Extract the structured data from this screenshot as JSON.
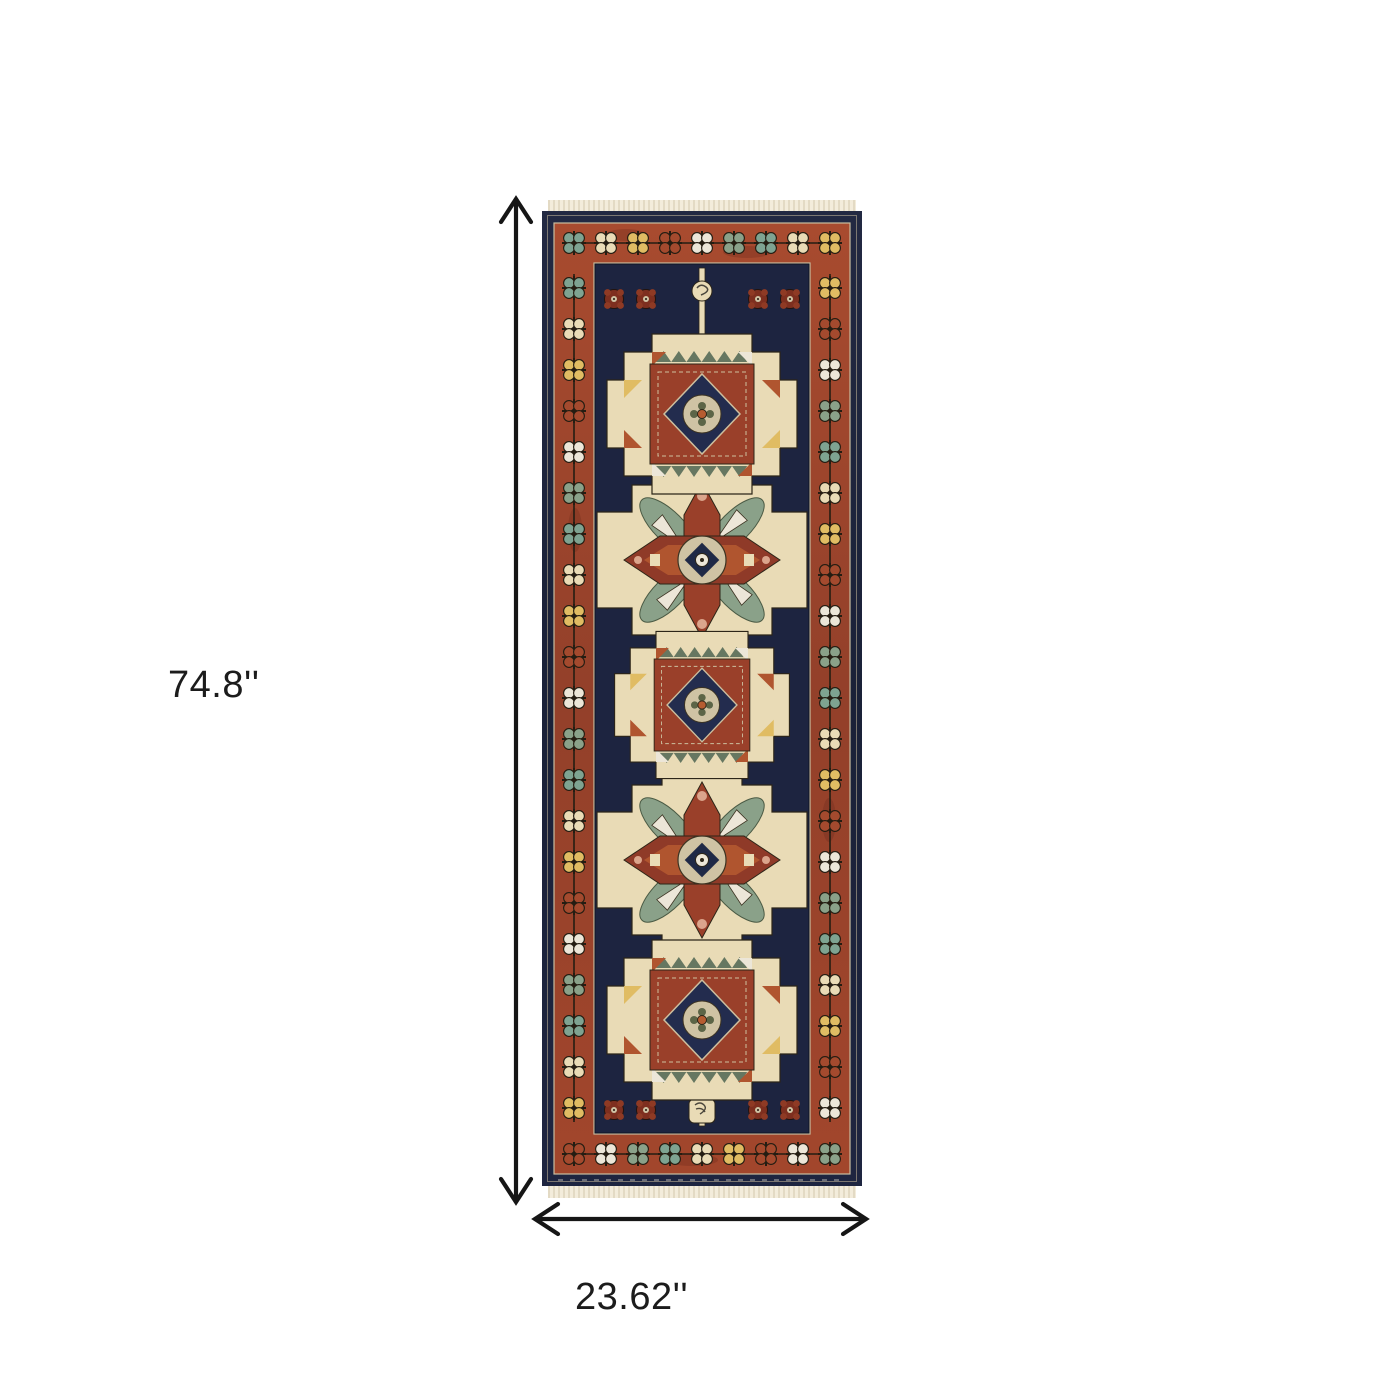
{
  "page": {
    "background": "#ffffff"
  },
  "diagram": {
    "height_label": "74.8''",
    "width_label": "23.62''",
    "arrow_color": "#161616",
    "label_color": "#1c1c1c"
  },
  "rug": {
    "name": "oriental-runner-rug",
    "style": "navy and rust geometric medallion runner with fringe",
    "palette": {
      "navy": "#1d2440",
      "navy_dark": "#161c30",
      "rust": "#a2462c",
      "rust_dark": "#8d3a26",
      "panel_red": "#9a402a",
      "dark_red": "#7e2f1f",
      "cream": "#e9dbb6",
      "beige": "#cfc3a4",
      "ivory": "#f3ecdb",
      "yellow": "#e0bc63",
      "teal": "#7ea391",
      "sage": "#8aa189",
      "white": "#ece6d8",
      "red": "#a44a2e",
      "peach": "#dba58c",
      "outline": "#2c2518"
    }
  }
}
